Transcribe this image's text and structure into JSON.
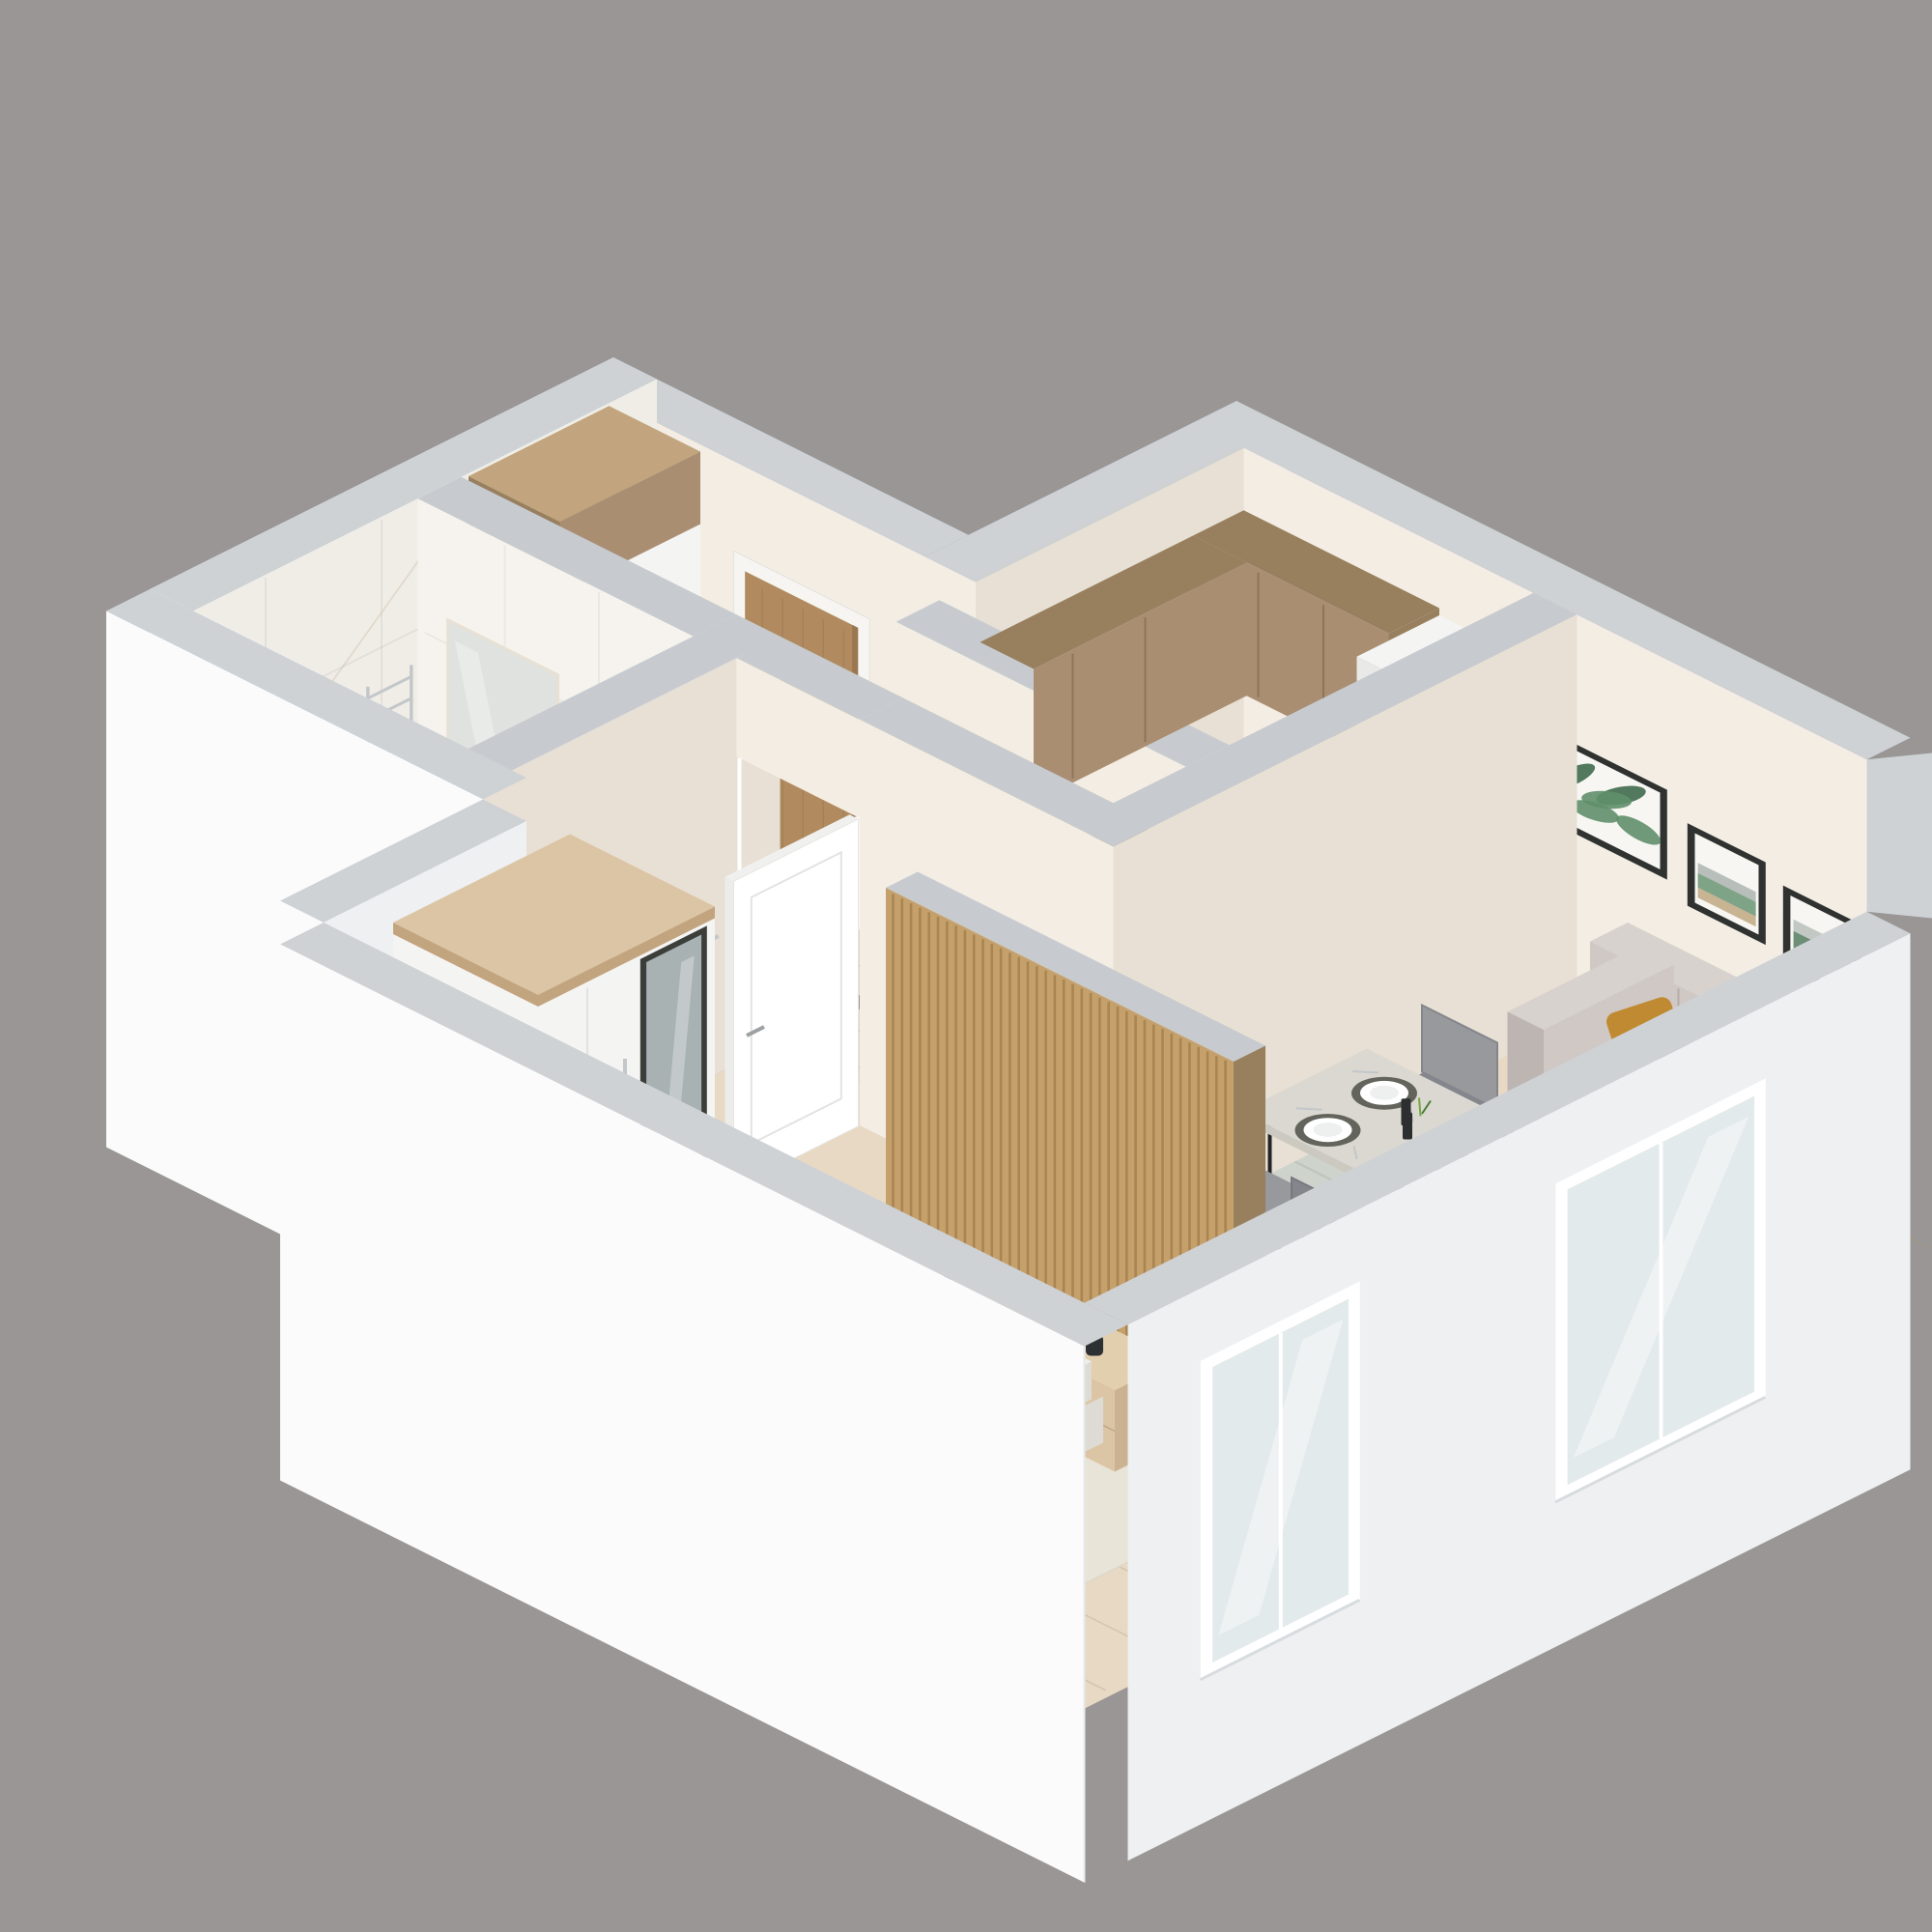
{
  "scene": {
    "description": "3D isometric cutaway floor plan render of a one-bedroom apartment, viewed from above at a 45-degree angle",
    "style": "photorealistic architectural visualization, cut walls shown as light gray bands, white exterior shell, no text or labels",
    "background_color": "#9a9695"
  },
  "colors": {
    "bg": "#9a9695",
    "wallTop": "#c7cbcf",
    "wallTopOuter": "#ced2d5",
    "wallLit": "#f3ede4",
    "wallLit2": "#ece5da",
    "wallShade": "#e8e0d4",
    "outerWhite": "#fbfbfc",
    "outerWhiteShade": "#eef0f2",
    "outerWhiteDim": "#f6f7f8",
    "marble": "#f0ede7",
    "marbleLit": "#f6f3ee",
    "marbleVein": "#cbb9a0",
    "floorWood": "#e7d9c4",
    "floorWoodHall": "#e3d4be",
    "plankLine": "#a98f6b",
    "floorBath": "#dcd9d2",
    "bathGrid": "#b9b6af",
    "floorKitchen": "#84868a",
    "kitchenVein": "#a9adb3",
    "wood": "#c2a47e",
    "slat": "#c6a06a",
    "slatGap": "#7a5a30",
    "woodLight": "#dcc5a4",
    "sideTop": "#e2cfae",
    "walnut": "#8a6e54",
    "walnutDark": "#7a6049",
    "cabinetWood": "#a98e72",
    "cabinetWoodSide": "#98805f",
    "white": "#ffffff",
    "cabinetWhite": "#f4f4f3",
    "cabinetWhiteShade": "#e9e9e8",
    "counterTop": "#eae5db",
    "black": "#202225",
    "darkGray": "#3a3d40",
    "chrome": "#c3c7ca",
    "frameDark": "#2f3230",
    "sofa": "#cfc8c4",
    "sofaShade": "#bdb5b1",
    "sofaLight": "#d8d2cf",
    "pillowMustard": "#c08a33",
    "pillowOlive": "#6d7850",
    "rugLiving": "#ced3cc",
    "rugLivingStripe": "#b3bab1",
    "rugBed": "#e9e4d8",
    "bedLinen": "#f0eeea",
    "bedLinenShade": "#dedad4",
    "bedThrow": "#b4b8bc",
    "bedThrowDark": "#9fa3a8",
    "blush": "#d3c4be",
    "chairGray": "#97999d",
    "chairGrayDark": "#84868b",
    "tableTop": "#dbd8d1",
    "tableSide": "#ccc9c1",
    "doorWood": "#b18b5f",
    "doorWoodDark": "#9a7750",
    "doorFrame": "#f6f5f2",
    "glass": "#e3eaec",
    "glassDoor": "#d8e2e4",
    "artGreen": "#5f8f6a",
    "artGreenDark": "#3f6b4d",
    "artGold": "#b3986b",
    "artGray": "#8e9a93",
    "artPaper": "#f7f6f2",
    "plantGreen": "#6faa3c",
    "plantDark": "#4e7d3a",
    "potDark": "#2e3134"
  },
  "rooms": [
    {
      "id": "hallway",
      "furniture": [
        "entrance-door",
        "doorbell",
        "hall-wardrobe",
        "hall-mirror"
      ]
    },
    {
      "id": "bathroom",
      "furniture": [
        "bathtub",
        "washing-machine",
        "towel-stack",
        "vanity-cabinet",
        "toilet",
        "flush-plate",
        "towel-radiator",
        "toilet-paper-holder",
        "glass-door"
      ]
    },
    {
      "id": "kitchen",
      "furniture": [
        "upper-cabinets",
        "counter-cabinets",
        "cooktop",
        "oven",
        "sink",
        "faucet",
        "glasses",
        "tall-cabinet"
      ]
    },
    {
      "id": "living-dining",
      "furniture": [
        "dining-table",
        "dining-chairs",
        "place-settings",
        "wall-art-leaf",
        "wall-art-abstract-1",
        "wall-art-abstract-2",
        "sofa",
        "sofa-cushions",
        "living-rug",
        "coffee-tables",
        "vase-dried-flowers",
        "living-window"
      ]
    },
    {
      "id": "bedroom",
      "furniture": [
        "white-door",
        "slat-partition",
        "sideboard",
        "plants",
        "notebook",
        "vase",
        "bedroom-wardrobe-mirror",
        "bedroom-rug",
        "double-bed",
        "pillows",
        "throw-blanket",
        "bedroom-window",
        "plant-sprig"
      ]
    }
  ]
}
